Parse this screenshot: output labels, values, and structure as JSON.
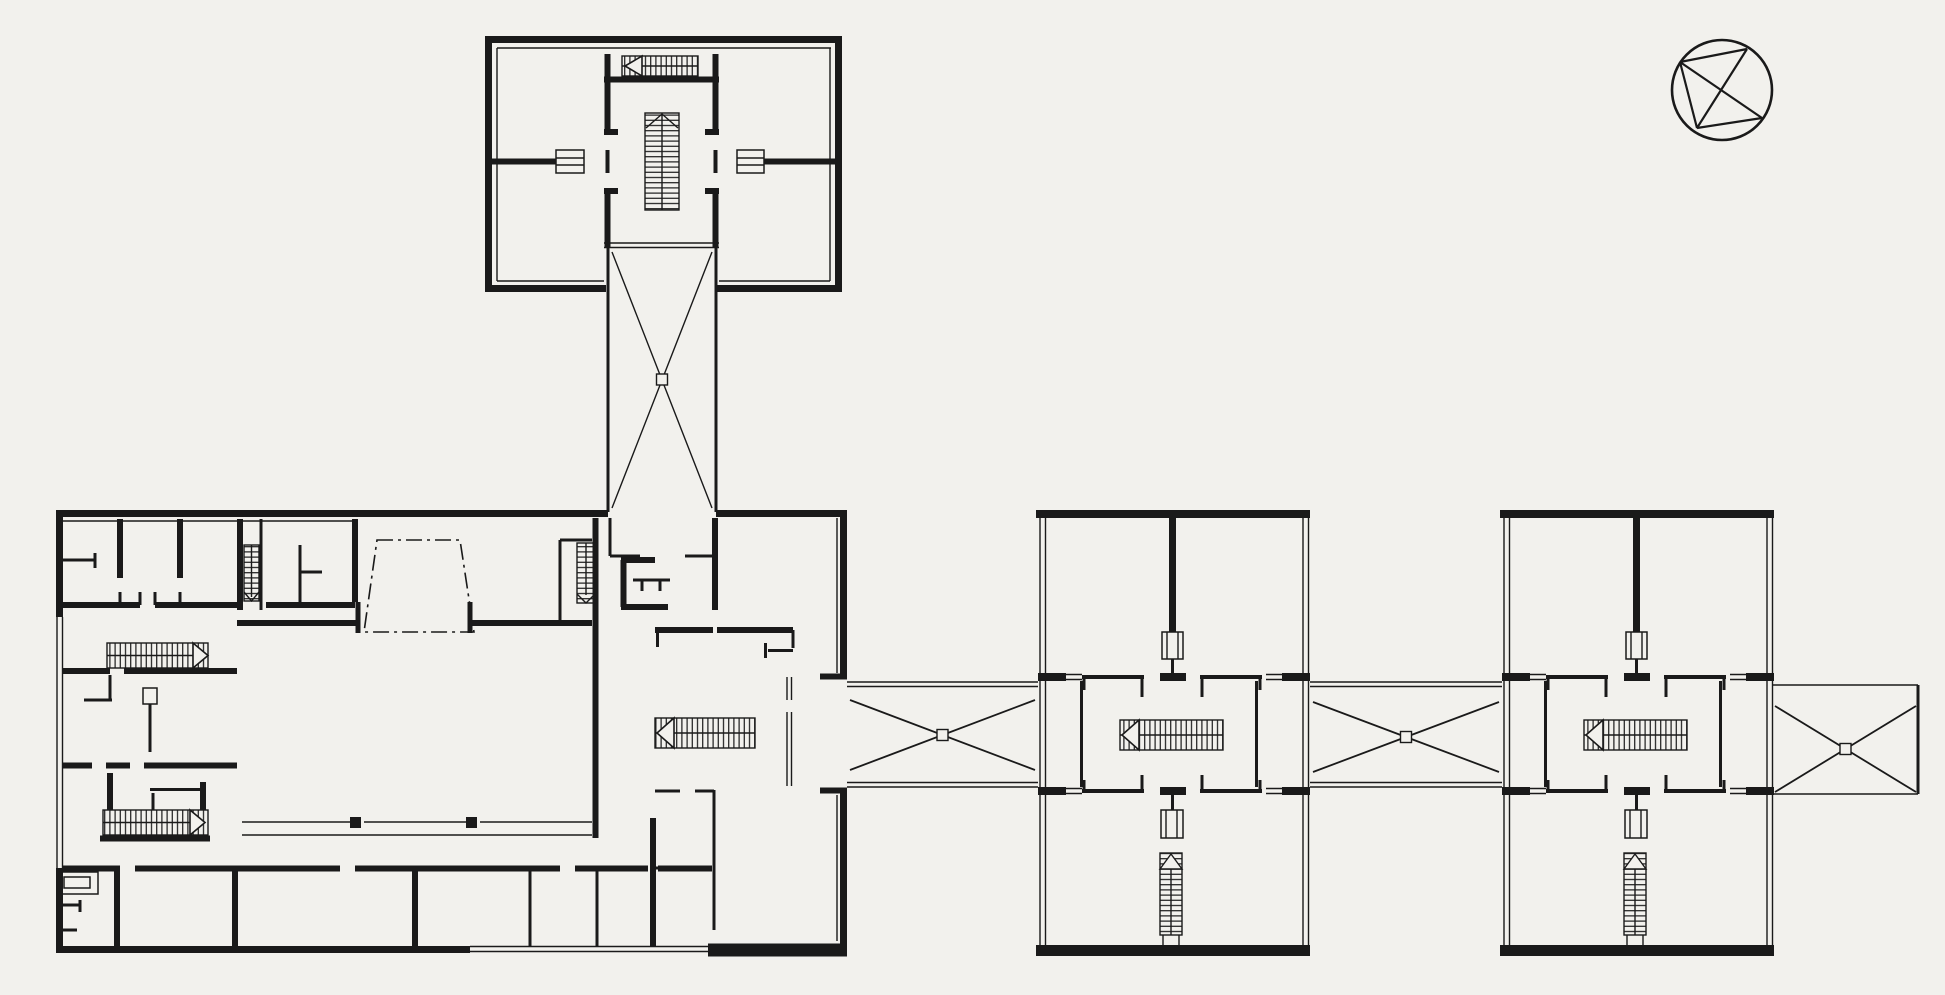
{
  "canvas": {
    "width": 1945,
    "height": 995
  },
  "colors": {
    "paper": "#f2f1ed",
    "ink": "#1a1a1a"
  },
  "plan": {
    "kind": "architectural floor plan, black line drawing on photographic paper",
    "buildings": [
      {
        "id": "north-pavilion",
        "label": "North pavilion with central stair core"
      },
      {
        "id": "main-building",
        "label": "Main building with inner courtyard and dash-dot auditorium outline"
      },
      {
        "id": "satellite-building-1",
        "label": "Middle pavilion with central stair and elevator core"
      },
      {
        "id": "satellite-building-2",
        "label": "East pavilion with central stair and elevator core"
      }
    ],
    "links": [
      {
        "id": "north-link",
        "label": "Cross-braced link corridor to north pavilion"
      },
      {
        "id": "link-1",
        "label": "Cross-braced link corridor between main building and middle pavilion"
      },
      {
        "id": "link-2",
        "label": "Cross-braced link corridor between middle and east pavilions"
      },
      {
        "id": "east-link",
        "label": "Cross-braced open-ended corridor east of east pavilion"
      }
    ],
    "symbols": [
      {
        "id": "north-arrow",
        "label": "Compass / north arrow circle, top right"
      }
    ],
    "features": {
      "stairs": 11,
      "elevators": 4,
      "courtyards": 1
    }
  }
}
